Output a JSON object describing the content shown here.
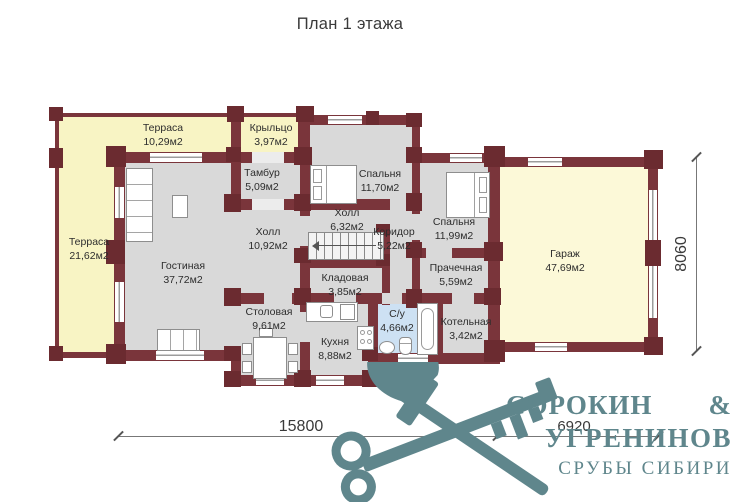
{
  "title": "План 1 этажа",
  "rooms": {
    "terrace_top": {
      "name": "Терраса",
      "area": "10,29м2"
    },
    "porch": {
      "name": "Крыльцо",
      "area": "3,97м2"
    },
    "terrace_left": {
      "name": "Терраса",
      "area": "21,62м2"
    },
    "tambur": {
      "name": "Тамбур",
      "area": "5,09м2"
    },
    "bedroom1": {
      "name": "Спальня",
      "area": "11,70м2"
    },
    "hall_small": {
      "name": "Холл",
      "area": "6,32м2"
    },
    "corridor": {
      "name": "Коридор",
      "area": "5,22м2"
    },
    "bedroom2": {
      "name": "Спальня",
      "area": "11,99м2"
    },
    "hall_big": {
      "name": "Холл",
      "area": "10,92м2"
    },
    "living": {
      "name": "Гостиная",
      "area": "37,72м2"
    },
    "storage": {
      "name": "Кладовая",
      "area": "3,85м2"
    },
    "laundry": {
      "name": "Прачечная",
      "area": "5,59м2"
    },
    "dining": {
      "name": "Столовая",
      "area": "9,61м2"
    },
    "kitchen": {
      "name": "Кухня",
      "area": "8,88м2"
    },
    "bathroom": {
      "name": "С/у",
      "area": "4,66м2"
    },
    "boiler": {
      "name": "Котельная",
      "area": "3,42м2"
    },
    "garage": {
      "name": "Гараж",
      "area": "47,69м2"
    }
  },
  "dimensions": {
    "main_width": "15800",
    "garage_width": "6920",
    "garage_depth": "8060"
  },
  "logo": {
    "name_top": "СОРОКИН",
    "ampersand": "&",
    "name_bottom": "УГРЕНИНОВ",
    "tagline": "СРУБЫ СИБИРИ"
  },
  "colors": {
    "wall": "#7a353b",
    "terrace": "#f8f4c4",
    "garage": "#fcf9d8",
    "room": "#d9d9d9",
    "bathroom": "#cde1f3",
    "logo": "#5f868c"
  }
}
